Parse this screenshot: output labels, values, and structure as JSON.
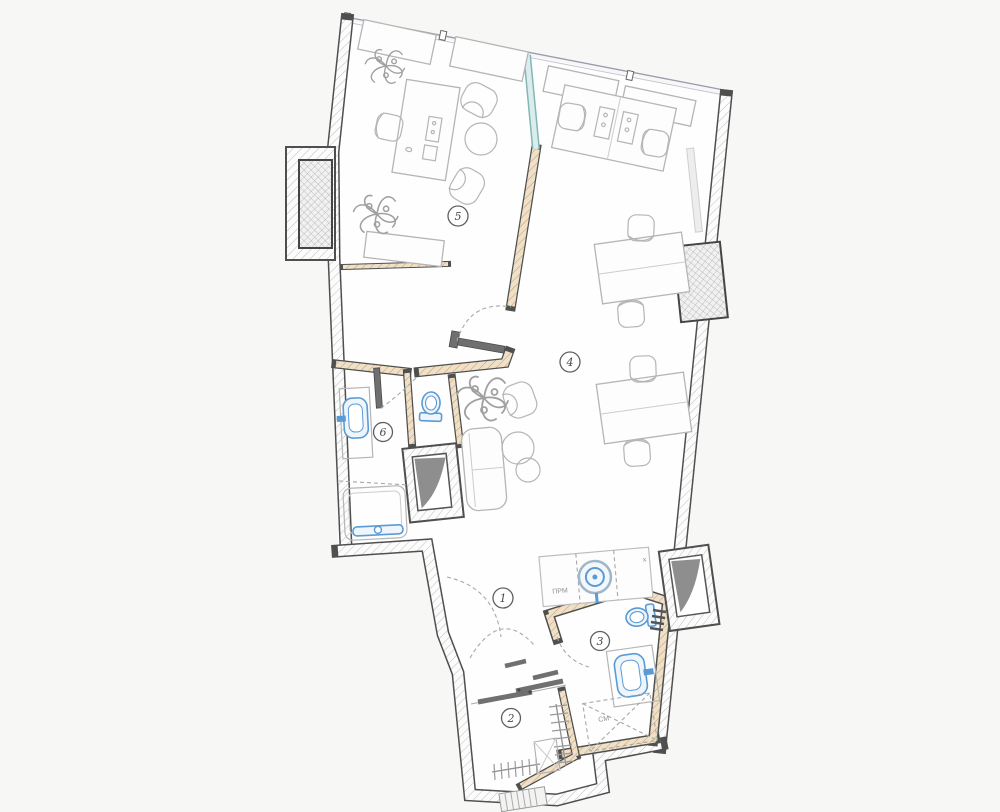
{
  "plan": {
    "kind": "architectural-floor-plan",
    "rooms": [
      {
        "number": "1"
      },
      {
        "number": "2"
      },
      {
        "number": "3"
      },
      {
        "number": "4"
      },
      {
        "number": "5"
      },
      {
        "number": "6"
      }
    ],
    "annotations": {
      "appliance_counter": "ПРМ",
      "washing_machine": "СМ",
      "cross_mark": "х"
    },
    "colors": {
      "background": "#f7f8f5",
      "floor": "#fefefe",
      "wall_outline": "#4f4f4f",
      "wall_hatch": "#b6b6b6",
      "wood_hatch": "#c09159",
      "wood_fill": "#efe1c9",
      "glass_partition": "#cfe9e9",
      "fixture_blue": "#5b9bd5",
      "shaft_gray": "#8e8e8e",
      "furniture_gray": "#b5b5b5",
      "door_dark": "#6f6f6f"
    }
  }
}
